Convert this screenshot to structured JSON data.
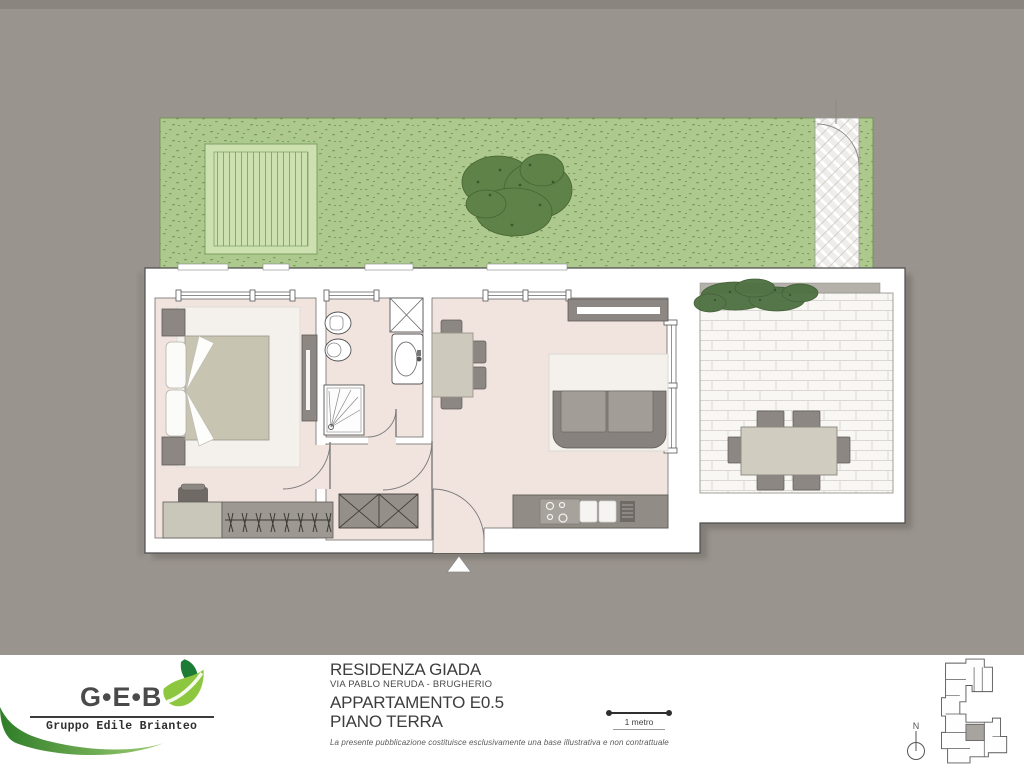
{
  "footer": {
    "logo": {
      "initials": "G•E•B",
      "tagline": "Gruppo Edile Brianteo"
    },
    "project": {
      "title": "RESIDENZA GIADA",
      "address": "VIA PABLO NERUDA - BRUGHERIO",
      "unit": "APPARTAMENTO E0.5",
      "floor": "PIANO TERRA"
    },
    "disclaimer": "La presente pubblicazione costituisce esclusivamente una base illustrativa e non contrattuale",
    "scale_label": "1 metro",
    "compass_label": "N"
  },
  "plan": {
    "features": [
      "garden",
      "wood-deck",
      "tree",
      "paved-path",
      "double-bed",
      "wardrobe",
      "hanger-rail",
      "pouf",
      "toilet",
      "bidet",
      "washing-machine",
      "sink",
      "shower",
      "kitchen-counter",
      "hob",
      "kitchen-sink",
      "sideboard",
      "dining-table",
      "sofa",
      "terrace-paving",
      "hedge-planter",
      "outdoor-table",
      "entrance-marker",
      "key-plan",
      "north-compass"
    ]
  },
  "palette": {
    "background": "#9a948e",
    "background_top": "#8b8580",
    "grass": "#adc98d",
    "grass_speckle": "#6d9052",
    "deck": "#cde0af",
    "tree": "#5b7f45",
    "wall_white": "#ffffff",
    "wall_stroke": "#4e4e4e",
    "floor_pink": "#f1e4df",
    "furniture_dark": "#8c8782",
    "furniture_light": "#c9c6ba",
    "rug": "#f4f1ec",
    "terrace_paving": "#f8f7f4",
    "shadow": "#6e6963",
    "logo_green_dark": "#1c7c35",
    "logo_green_light": "#8dc63f",
    "text_dark": "#3d3d3d"
  }
}
